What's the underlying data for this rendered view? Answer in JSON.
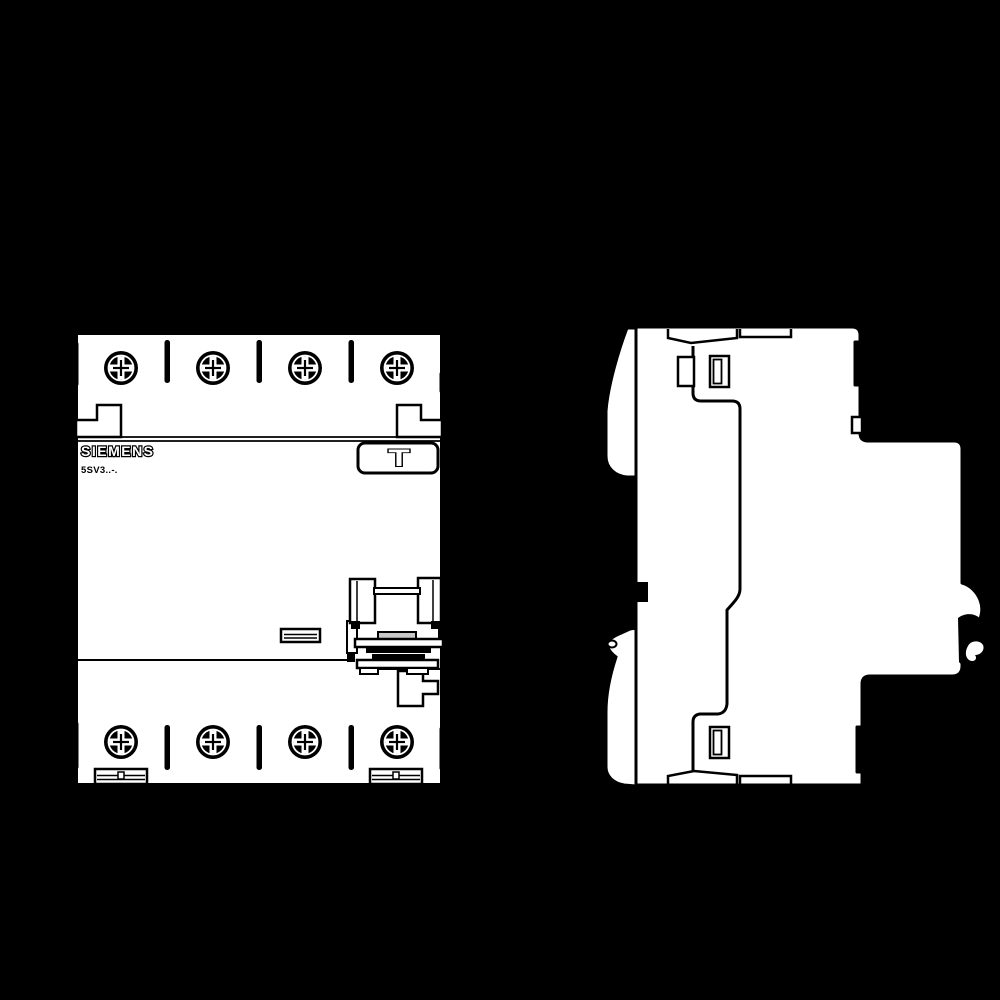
{
  "page": {
    "background_color": "#000000"
  },
  "drawing": {
    "brand_label": "SIEMENS",
    "model_label": "5SV3..-.",
    "test_button_symbol": "T",
    "body_fill": "#ffffff",
    "line_color": "#000000",
    "knob_color": "#c8c8c8"
  }
}
